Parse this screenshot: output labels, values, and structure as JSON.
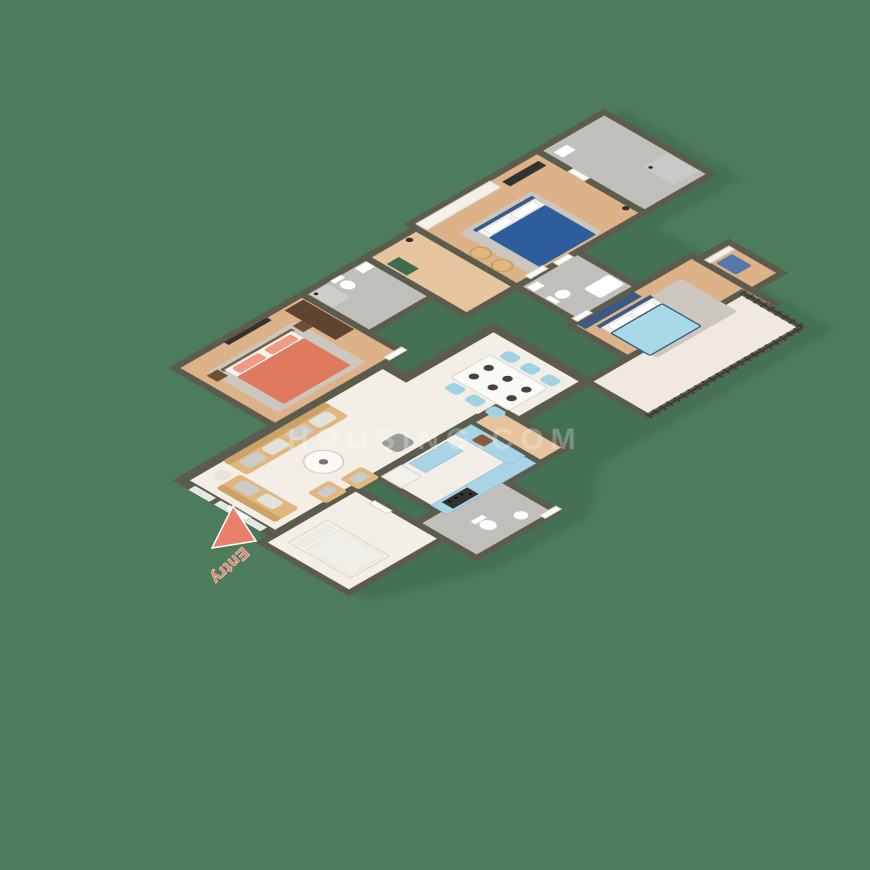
{
  "canvas": {
    "width": 870,
    "height": 870
  },
  "entry": {
    "label": "Entry"
  },
  "watermark": {
    "text": "HOUSING.COM"
  },
  "colors": {
    "background": "#4d7c5c",
    "wall": "#5b5c4d",
    "floor_marble": "#f3eee6",
    "floor_wood": "#ddb288",
    "floor_wood_light": "#e6c49e",
    "floor_tile": "#c0bfbc",
    "rug_gray": "#ccc7be",
    "bed_coral": "#e07a5e",
    "pillow_coral": "#ef9a82",
    "headboard_brown": "#7a5a40",
    "bed_blue": "#2e5d9c",
    "bed_lightblue": "#a9d8e6",
    "accent_navy": "#3a5a85",
    "sofa_tan": "#e2b77e",
    "cushion_gray": "#c9cccb",
    "table_white": "#fafaf7",
    "chair_blue": "#9fd2e2",
    "cabinet_blue": "#a9d4e6",
    "sink_brown": "#8a5a3a",
    "dark_appliance": "#33322e",
    "wardrobe_brown": "#5f4531",
    "white_furniture": "#f4f1ea",
    "pouf_gray": "#9b9b98",
    "mat_green": "#3f6b4e",
    "shadow": "#3e684c",
    "entry": "#e8806b"
  },
  "regions": [
    {
      "name": "living-room"
    },
    {
      "name": "dining-area"
    },
    {
      "name": "master-bedroom"
    },
    {
      "name": "master-bathroom"
    },
    {
      "name": "hallway"
    },
    {
      "name": "bedroom-2"
    },
    {
      "name": "bedroom-3"
    },
    {
      "name": "common-bathroom"
    },
    {
      "name": "ensuite-bathroom"
    },
    {
      "name": "kitchen"
    },
    {
      "name": "utility-room"
    },
    {
      "name": "utility-bathroom"
    },
    {
      "name": "balcony"
    },
    {
      "name": "entry"
    }
  ]
}
